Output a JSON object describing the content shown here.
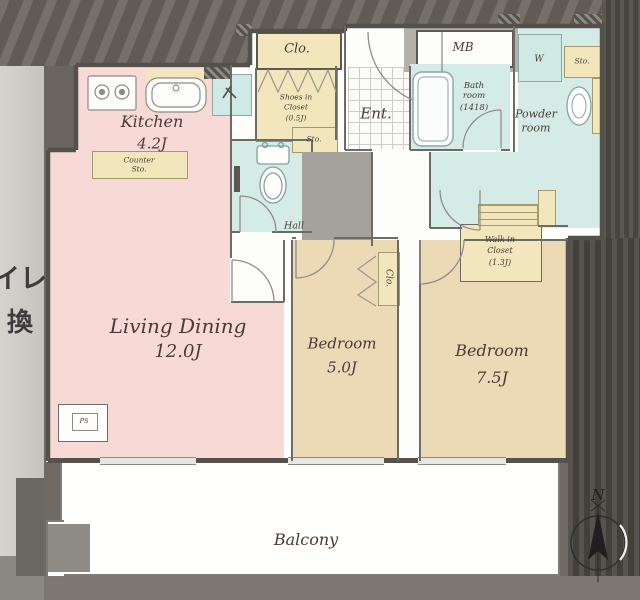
{
  "plan": {
    "kitchen": {
      "name": "Kitchen",
      "size": "4.2J"
    },
    "living": {
      "name": "Living Dining",
      "size": "12.0J"
    },
    "bedroom_small": {
      "name": "Bedroom",
      "size": "5.0J"
    },
    "bedroom_large": {
      "name": "Bedroom",
      "size": "7.5J"
    },
    "balcony": {
      "name": "Balcony"
    },
    "entrance": {
      "name": "Ent."
    },
    "hall": {
      "name": "Hall"
    },
    "meter_box": {
      "name": "MB"
    },
    "bath": {
      "name_line1": "Bath",
      "name_line2": "room",
      "size": "(1418)"
    },
    "powder": {
      "name_line1": "Powder",
      "name_line2": "room"
    },
    "walk_in_closet": {
      "name_line1": "Walk in",
      "name_line2": "Closet",
      "size": "(1.3J)"
    },
    "shoes_closet": {
      "name_line1": "Shoes in",
      "name_line2": "Closet",
      "size": "(0.5J)"
    },
    "closet_entry": {
      "name": "Clo."
    },
    "closet_bedroom": {
      "name": "Clo."
    },
    "counter_storage": {
      "line1": "Counter",
      "line2": "Sto."
    },
    "storage_hall": {
      "name": "Sto."
    },
    "storage_powder": {
      "name": "Sto."
    },
    "washer": {
      "name": "W"
    },
    "pipe_space": {
      "name": "PS"
    }
  },
  "compass": {
    "north": "N"
  },
  "background": {
    "fragment_1": "イレ）",
    "fragment_2": "換"
  },
  "colors": {
    "room_pink": "#f7d9d6",
    "room_tan": "#ecd9b6",
    "room_teal": "#d4ebe6",
    "closet_yellow": "#f2e7bc",
    "wall_dark": "#54504b",
    "shaft_gray": "#a5a29e"
  }
}
